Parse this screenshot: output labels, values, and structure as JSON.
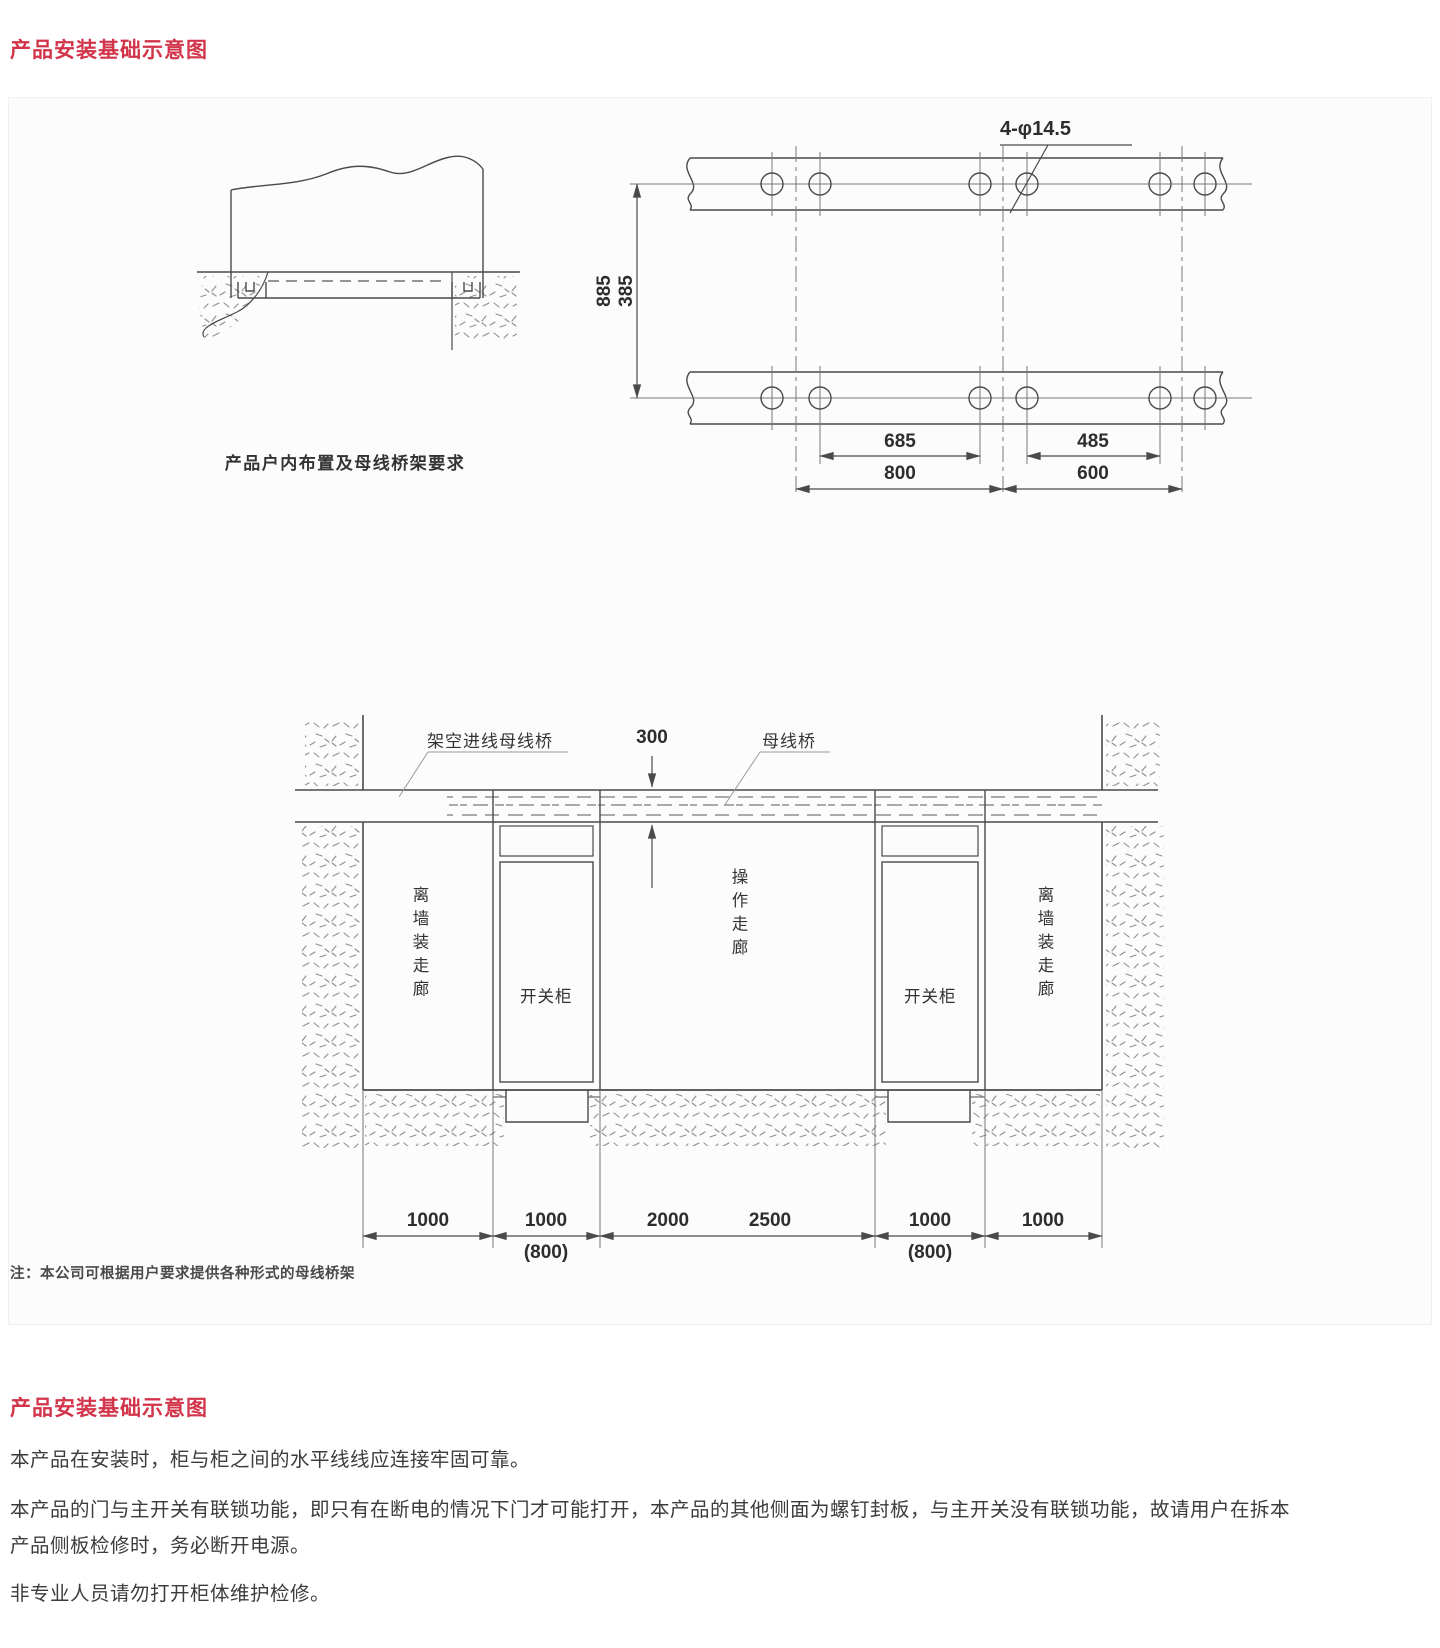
{
  "colors": {
    "accent_red": "#d2344a",
    "line": "#4a4a4a",
    "speckle": "#8f8f8f",
    "text": "#3c3c3c"
  },
  "header": {
    "title": "产品安装基础示意图"
  },
  "figure": {
    "indoor_layout": {
      "caption": "产品户内布置及母线桥架要求"
    },
    "channel_plan": {
      "hole_label": "4-φ14.5",
      "dim_vertical_outer": "885",
      "dim_vertical_inner": "385",
      "dim_hole_span_left": "685",
      "dim_hole_span_right": "485",
      "dim_center_span_left": "800",
      "dim_center_span_right": "600"
    },
    "room_section": {
      "label_overhead_bus": "架空进线母线桥",
      "label_clearance": "300",
      "label_bus_bridge": "母线桥",
      "label_wall_corridor_left": "离墙装走廊",
      "label_cabinet_left": "开关柜",
      "label_operation_corridor": "操作走廊",
      "label_cabinet_right": "开关柜",
      "label_wall_corridor_right": "离墙装走廊",
      "dims_bottom": [
        "1000",
        "1000",
        "2000",
        "2500",
        "1000",
        "1000"
      ],
      "dims_bottom_alt": [
        "(800)",
        "(800)"
      ]
    },
    "note": "注：本公司可根据用户要求提供各种形式的母线桥架"
  },
  "body": {
    "title": "产品安装基础示意图",
    "paragraphs": [
      "本产品在安装时，柜与柜之间的水平线线应连接牢固可靠。",
      "本产品的门与主开关有联锁功能，即只有在断电的情况下门才可能打开，本产品的其他侧面为螺钉封板，与主开关没有联锁功能，故请用户在拆本产品侧板检修时，务必断开电源。",
      "非专业人员请勿打开柜体维护检修。"
    ]
  }
}
